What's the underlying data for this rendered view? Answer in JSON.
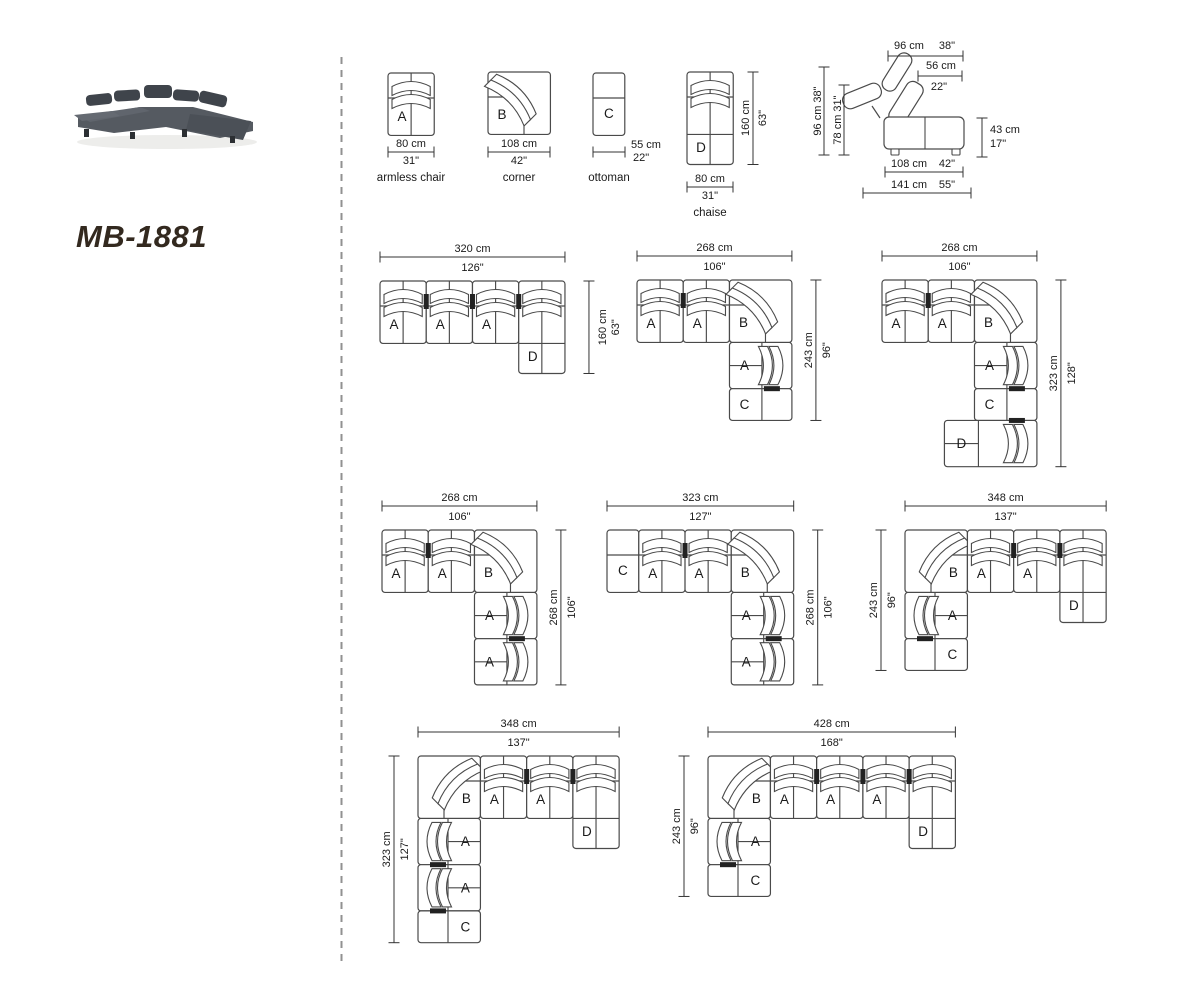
{
  "title": "MB-1881",
  "colors": {
    "line": "#4a4a4a",
    "text": "#1a1a1a",
    "divider": "#919191",
    "title": "#33291f",
    "mark": "#222222"
  },
  "legend": {
    "items": [
      {
        "letter": "A",
        "name": "armless chair",
        "dim_cm": "80 cm",
        "dim_in": "31\""
      },
      {
        "letter": "B",
        "name": "corner",
        "dim_cm": "108 cm",
        "dim_in": "42\""
      },
      {
        "letter": "C",
        "name": "ottoman",
        "dim_cm": "55 cm",
        "dim_in": "22\""
      },
      {
        "letter": "D",
        "name": "chaise",
        "dim_cm": "80 cm",
        "dim_in": "31\"",
        "height_cm": "160 cm",
        "height_in": "63\""
      }
    ]
  },
  "side_view": {
    "dims": [
      {
        "id": "top-total",
        "cm": "96 cm",
        "in": "38\""
      },
      {
        "id": "top-back",
        "cm": "56 cm",
        "in": "22\""
      },
      {
        "id": "left-total",
        "cm": "96 cm",
        "in": "38\""
      },
      {
        "id": "left-back",
        "cm": "78 cm",
        "in": "31\""
      },
      {
        "id": "seat-height",
        "cm": "43 cm",
        "in": "17\""
      },
      {
        "id": "bottom-seat",
        "cm": "108 cm",
        "in": "42\""
      },
      {
        "id": "bottom-total",
        "cm": "141 cm",
        "in": "55\""
      }
    ]
  },
  "configurations": [
    {
      "id": "config-1",
      "width_cm": "320 cm",
      "width_in": "126\"",
      "height_cm": "160 cm",
      "height_in": "63\"",
      "height_side": "right",
      "modules": [
        {
          "t": "A",
          "x": 0,
          "y": 0,
          "o": "top"
        },
        {
          "t": "A",
          "x": 80,
          "y": 0,
          "o": "top"
        },
        {
          "t": "A",
          "x": 160,
          "y": 0,
          "o": "top"
        },
        {
          "t": "D",
          "x": 240,
          "y": 0,
          "o": "top"
        }
      ]
    },
    {
      "id": "config-2",
      "width_cm": "268 cm",
      "width_in": "106\"",
      "height_cm": "243 cm",
      "height_in": "96\"",
      "height_side": "right",
      "modules": [
        {
          "t": "A",
          "x": 0,
          "y": 0,
          "o": "top"
        },
        {
          "t": "A",
          "x": 80,
          "y": 0,
          "o": "top"
        },
        {
          "t": "B",
          "x": 160,
          "y": 0,
          "o": "tr"
        },
        {
          "t": "A",
          "x": 160,
          "y": 108,
          "o": "right"
        },
        {
          "t": "C",
          "x": 160,
          "y": 188,
          "o": "right"
        }
      ]
    },
    {
      "id": "config-3",
      "width_cm": "268 cm",
      "width_in": "106\"",
      "height_cm": "323 cm",
      "height_in": "128\"",
      "height_side": "right",
      "modules": [
        {
          "t": "A",
          "x": 0,
          "y": 0,
          "o": "top"
        },
        {
          "t": "A",
          "x": 80,
          "y": 0,
          "o": "top"
        },
        {
          "t": "B",
          "x": 160,
          "y": 0,
          "o": "tr"
        },
        {
          "t": "A",
          "x": 160,
          "y": 108,
          "o": "right"
        },
        {
          "t": "C",
          "x": 160,
          "y": 188,
          "o": "right"
        },
        {
          "t": "D",
          "x": 108,
          "y": 243,
          "o": "right"
        }
      ]
    },
    {
      "id": "config-4",
      "width_cm": "268 cm",
      "width_in": "106\"",
      "height_cm": "268 cm",
      "height_in": "106\"",
      "height_side": "right",
      "modules": [
        {
          "t": "A",
          "x": 0,
          "y": 0,
          "o": "top"
        },
        {
          "t": "A",
          "x": 80,
          "y": 0,
          "o": "top"
        },
        {
          "t": "B",
          "x": 160,
          "y": 0,
          "o": "tr"
        },
        {
          "t": "A",
          "x": 160,
          "y": 108,
          "o": "right"
        },
        {
          "t": "A",
          "x": 160,
          "y": 188,
          "o": "right"
        }
      ]
    },
    {
      "id": "config-5",
      "width_cm": "323 cm",
      "width_in": "127\"",
      "height_cm": "268 cm",
      "height_in": "106\"",
      "height_side": "right",
      "modules": [
        {
          "t": "C",
          "x": 0,
          "y": 0,
          "o": "top"
        },
        {
          "t": "A",
          "x": 55,
          "y": 0,
          "o": "top"
        },
        {
          "t": "A",
          "x": 135,
          "y": 0,
          "o": "top"
        },
        {
          "t": "B",
          "x": 215,
          "y": 0,
          "o": "tr"
        },
        {
          "t": "A",
          "x": 215,
          "y": 108,
          "o": "right"
        },
        {
          "t": "A",
          "x": 215,
          "y": 188,
          "o": "right"
        }
      ]
    },
    {
      "id": "config-6",
      "width_cm": "348 cm",
      "width_in": "137\"",
      "height_cm": "243 cm",
      "height_in": "96\"",
      "height_side": "left",
      "modules": [
        {
          "t": "B",
          "x": 0,
          "y": 0,
          "o": "tl"
        },
        {
          "t": "A",
          "x": 108,
          "y": 0,
          "o": "top"
        },
        {
          "t": "A",
          "x": 188,
          "y": 0,
          "o": "top"
        },
        {
          "t": "D",
          "x": 268,
          "y": 0,
          "o": "top"
        },
        {
          "t": "A",
          "x": 0,
          "y": 108,
          "o": "left"
        },
        {
          "t": "C",
          "x": 0,
          "y": 188,
          "o": "left"
        }
      ]
    },
    {
      "id": "config-7",
      "width_cm": "348 cm",
      "width_in": "137\"",
      "height_cm": "323 cm",
      "height_in": "127\"",
      "height_side": "left",
      "modules": [
        {
          "t": "B",
          "x": 0,
          "y": 0,
          "o": "tl"
        },
        {
          "t": "A",
          "x": 108,
          "y": 0,
          "o": "top"
        },
        {
          "t": "A",
          "x": 188,
          "y": 0,
          "o": "top"
        },
        {
          "t": "D",
          "x": 268,
          "y": 0,
          "o": "top"
        },
        {
          "t": "A",
          "x": 0,
          "y": 108,
          "o": "left"
        },
        {
          "t": "A",
          "x": 0,
          "y": 188,
          "o": "left"
        },
        {
          "t": "C",
          "x": 0,
          "y": 268,
          "o": "left"
        }
      ]
    },
    {
      "id": "config-8",
      "width_cm": "428 cm",
      "width_in": "168\"",
      "height_cm": "243 cm",
      "height_in": "96\"",
      "height_side": "left",
      "modules": [
        {
          "t": "B",
          "x": 0,
          "y": 0,
          "o": "tl"
        },
        {
          "t": "A",
          "x": 108,
          "y": 0,
          "o": "top"
        },
        {
          "t": "A",
          "x": 188,
          "y": 0,
          "o": "top"
        },
        {
          "t": "A",
          "x": 268,
          "y": 0,
          "o": "top"
        },
        {
          "t": "D",
          "x": 348,
          "y": 0,
          "o": "top"
        },
        {
          "t": "A",
          "x": 0,
          "y": 108,
          "o": "left"
        },
        {
          "t": "C",
          "x": 0,
          "y": 188,
          "o": "left"
        }
      ]
    }
  ]
}
